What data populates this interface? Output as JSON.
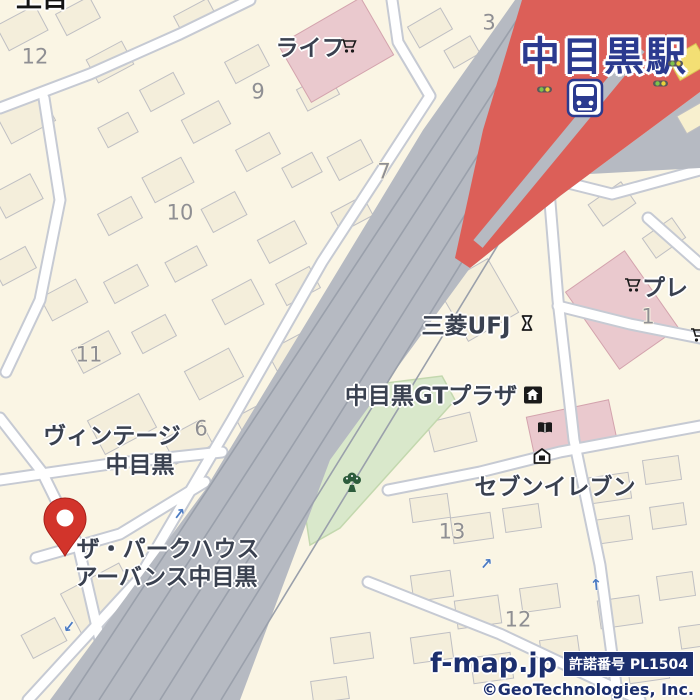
{
  "colors": {
    "background_cream": "#faf5e4",
    "station_red": "#dc5f58",
    "rail_gray": "#b6bac2",
    "rail_track_line": "#9aa0ab",
    "road_white": "#ffffff",
    "road_casing": "#c6cad3",
    "park_green": "#d9e8cb",
    "building_cream": "#f4eedb",
    "building_pink": "#eac9ce",
    "building_yellow": "#f3df74",
    "station_label_navy": "#2b3a8f",
    "poi_text": "#3a4150",
    "number_gray": "#8f8f93",
    "attribution_navy": "#1c2f6e",
    "pin_red": "#d2342b",
    "oneway_arrow_blue": "#4a7ac2"
  },
  "station": {
    "name": "中目黒駅"
  },
  "pois": {
    "life": "ライフ",
    "bank": "三菱UFJ",
    "gt_plaza": "中目黒GTプラザ",
    "seven_eleven": "セブンイレブン",
    "vintage_line1": "ヴィンテージ",
    "vintage_line2": "中目黒",
    "parkhouse_line1": "ザ・パークハウス",
    "parkhouse_line2": "アーバンス中目黒",
    "place_right_edge": "プレ",
    "partial_top_left": "上目"
  },
  "block_numbers": [
    "12",
    "3",
    "9",
    "7",
    "10",
    "11",
    "6",
    "1",
    "13",
    "12"
  ],
  "icons": {
    "train_station": "train-station-icon",
    "shopping_cart": "cart-icon",
    "bank_symbol": "bank-icon",
    "public_building": "building-badge-icon",
    "book": "book-icon",
    "shop_house": "shop-house-icon",
    "park_tree": "park-tree-icon",
    "traffic_signal": "traffic-signal-icon",
    "one_way_arrow": "one-way-arrow-icon",
    "map_pin": "location-pin-icon"
  },
  "attribution": {
    "site": "f-map.jp",
    "license": "許諾番号 PL1504",
    "copyright": "©GeoTechnologies, Inc."
  }
}
